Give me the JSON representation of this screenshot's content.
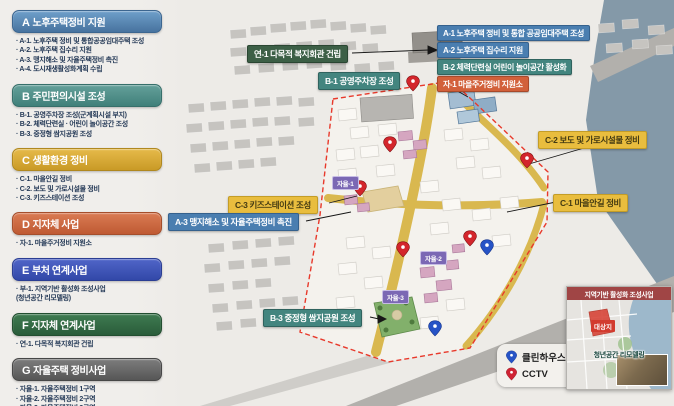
{
  "sidebar": {
    "sections": [
      {
        "code": "A",
        "title": "노후주택정비 지원",
        "color": "#4a7eb0",
        "items": [
          "A-1. 노후주택 정비 및 통합공공임대주택 조성",
          "A-2. 노후주택 집수리 지원",
          "A-3. 맹지해소 및 자율주택정비 촉진",
          "A-4. 도시재생활성화계획 수립"
        ]
      },
      {
        "code": "B",
        "title": "주민편의시설 조성",
        "color": "#43857f",
        "items": [
          "B-1. 공영주차장 조성(군계획시설 부지)",
          "B-2. 체력단련실 · 어린이 놀이공간 조성",
          "B-3. 중정형 쌈지공원 조성"
        ]
      },
      {
        "code": "C",
        "title": "생활환경 정비",
        "color": "#d9a82e",
        "items": [
          "C-1. 마을안길 정비",
          "C-2. 보도 및 가로시설물 정비",
          "C-3. 키즈스테이션 조성"
        ]
      },
      {
        "code": "D",
        "title": "지자체 사업",
        "color": "#d2603a",
        "items": [
          "자-1. 마을주거정비 지원소"
        ]
      },
      {
        "code": "E",
        "title": "부처 연계사업",
        "color": "#3a4fb0",
        "items": [
          "부-1. 지역기반 활성화 조성사업\n(청년공간 리모델링)"
        ]
      },
      {
        "code": "F",
        "title": "지자체 연계사업",
        "color": "#2f5e3e",
        "items": [
          "연-1. 다목적 복지회관 건립"
        ]
      },
      {
        "code": "G",
        "title": "자율주택 정비사업",
        "color": "#5f5f5f",
        "items": [
          "자율-1. 자율주택정비 1구역",
          "자율-2. 자율주택정비 2구역",
          "자율-3. 자율주택정비 3구역"
        ]
      }
    ]
  },
  "map": {
    "callouts": [
      {
        "id": "yeon1",
        "text": "연-1 다목적 복지회관 건립",
        "type": "green-dark"
      },
      {
        "id": "b1",
        "text": "B-1 공영주차장 조성",
        "type": "teal"
      },
      {
        "id": "a1",
        "text": "A-1 노후주택 정비 및 통합 공공임대주택 조성",
        "type": "blue"
      },
      {
        "id": "a2",
        "text": "A-2 노후주택 집수리 지원",
        "type": "blue"
      },
      {
        "id": "b2",
        "text": "B-2 체력단련실 어린이 놀이공간 활성화",
        "type": "teal"
      },
      {
        "id": "ja1",
        "text": "자-1 마을주거정비 지원소",
        "type": "orange"
      },
      {
        "id": "c2",
        "text": "C-2 보도 및 가로시설물 정비",
        "type": "yellow"
      },
      {
        "id": "c1",
        "text": "C-1 마을안길 정비",
        "type": "yellow"
      },
      {
        "id": "c3",
        "text": "C-3 키즈스테이션 조성",
        "type": "yellow"
      },
      {
        "id": "a3",
        "text": "A-3 맹지해소 및 자율주택정비 촉진",
        "type": "blue"
      },
      {
        "id": "b3",
        "text": "B-3 중정형 쌈지공원 조성",
        "type": "teal"
      }
    ],
    "badges": [
      {
        "text": "자율-1"
      },
      {
        "text": "자율-2"
      },
      {
        "text": "자율-3"
      }
    ],
    "legend": {
      "items": [
        {
          "label": "클린하우스",
          "pin_color": "#2653c6"
        },
        {
          "label": "CCTV",
          "pin_color": "#cf2333"
        }
      ]
    },
    "inset": {
      "title": "지역기반 활성화 조성사업",
      "area_label": "대상지",
      "photo_label": "청년공간 리모델링"
    },
    "palette": {
      "boundary_red": "#e8392b",
      "road_yellow": "#d9b84f",
      "badge_purple": "#7b68b4",
      "river": "#8499a8"
    }
  }
}
